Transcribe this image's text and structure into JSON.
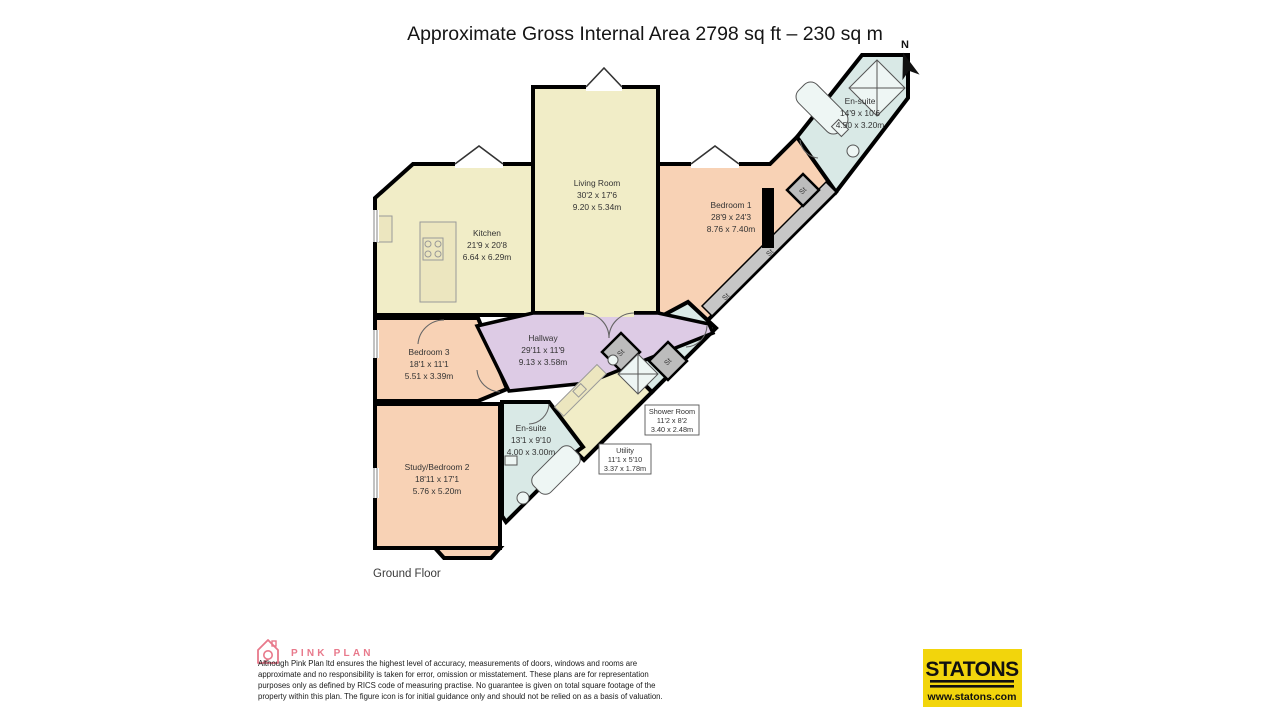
{
  "title": "Approximate Gross Internal Area 2798 sq ft – 230 sq m",
  "floor_label": "Ground Floor",
  "compass": {
    "label": "N"
  },
  "storage_label": "St",
  "rooms": {
    "living_room": {
      "name": "Living Room",
      "imperial": "30'2 x 17'6",
      "metric": "9.20 x 5.34m"
    },
    "kitchen": {
      "name": "Kitchen",
      "imperial": "21'9 x 20'8",
      "metric": "6.64 x 6.29m"
    },
    "bedroom_1": {
      "name": "Bedroom 1",
      "imperial": "28'9 x 24'3",
      "metric": "8.76 x 7.40m"
    },
    "ensuite_top": {
      "name": "En-suite",
      "imperial": "14'9 x 10'6",
      "metric": "4.50 x 3.20m"
    },
    "bedroom_3": {
      "name": "Bedroom 3",
      "imperial": "18'1 x 11'1",
      "metric": "5.51 x 3.39m"
    },
    "hallway": {
      "name": "Hallway",
      "imperial": "29'11 x 11'9",
      "metric": "9.13 x 3.58m"
    },
    "study_bedroom_2": {
      "name": "Study/Bedroom 2",
      "imperial": "18'11 x 17'1",
      "metric": "5.76 x 5.20m"
    },
    "ensuite_bottom": {
      "name": "En-suite",
      "imperial": "13'1 x 9'10",
      "metric": "4.00 x 3.00m"
    },
    "shower_room": {
      "name": "Shower Room",
      "imperial": "11'2 x 8'2",
      "metric": "3.40 x 2.48m"
    },
    "utility": {
      "name": "Utility",
      "imperial": "11'1 x 5'10",
      "metric": "3.37 x 1.78m"
    }
  },
  "colors": {
    "reception_fill": "#f1edc7",
    "bedroom_fill": "#f8d2b5",
    "bathroom_fill": "#d9e9e6",
    "hallway_fill": "#ddcbe5",
    "storage_fill": "#bcbcbc",
    "wall": "#000000",
    "pink_brand": "#e8798b",
    "statons_yellow": "#f2d50c"
  },
  "footer": {
    "brand": "PINK PLAN",
    "disclaimer_lines": [
      "Although Pink Plan ltd ensures the highest level of accuracy, measurements of doors, windows and rooms are",
      "approximate and no responsibility is taken for error, omission or misstatement. These plans are for representation",
      "purposes only as defined by RICS code of measuring practise. No guarantee is given on total square footage of the",
      "property within this plan. The figure icon is for initial guidance only and should not be relied on as a basis of valuation."
    ],
    "agent_logo": {
      "name": "STATONS",
      "website": "www.statons.com"
    }
  }
}
